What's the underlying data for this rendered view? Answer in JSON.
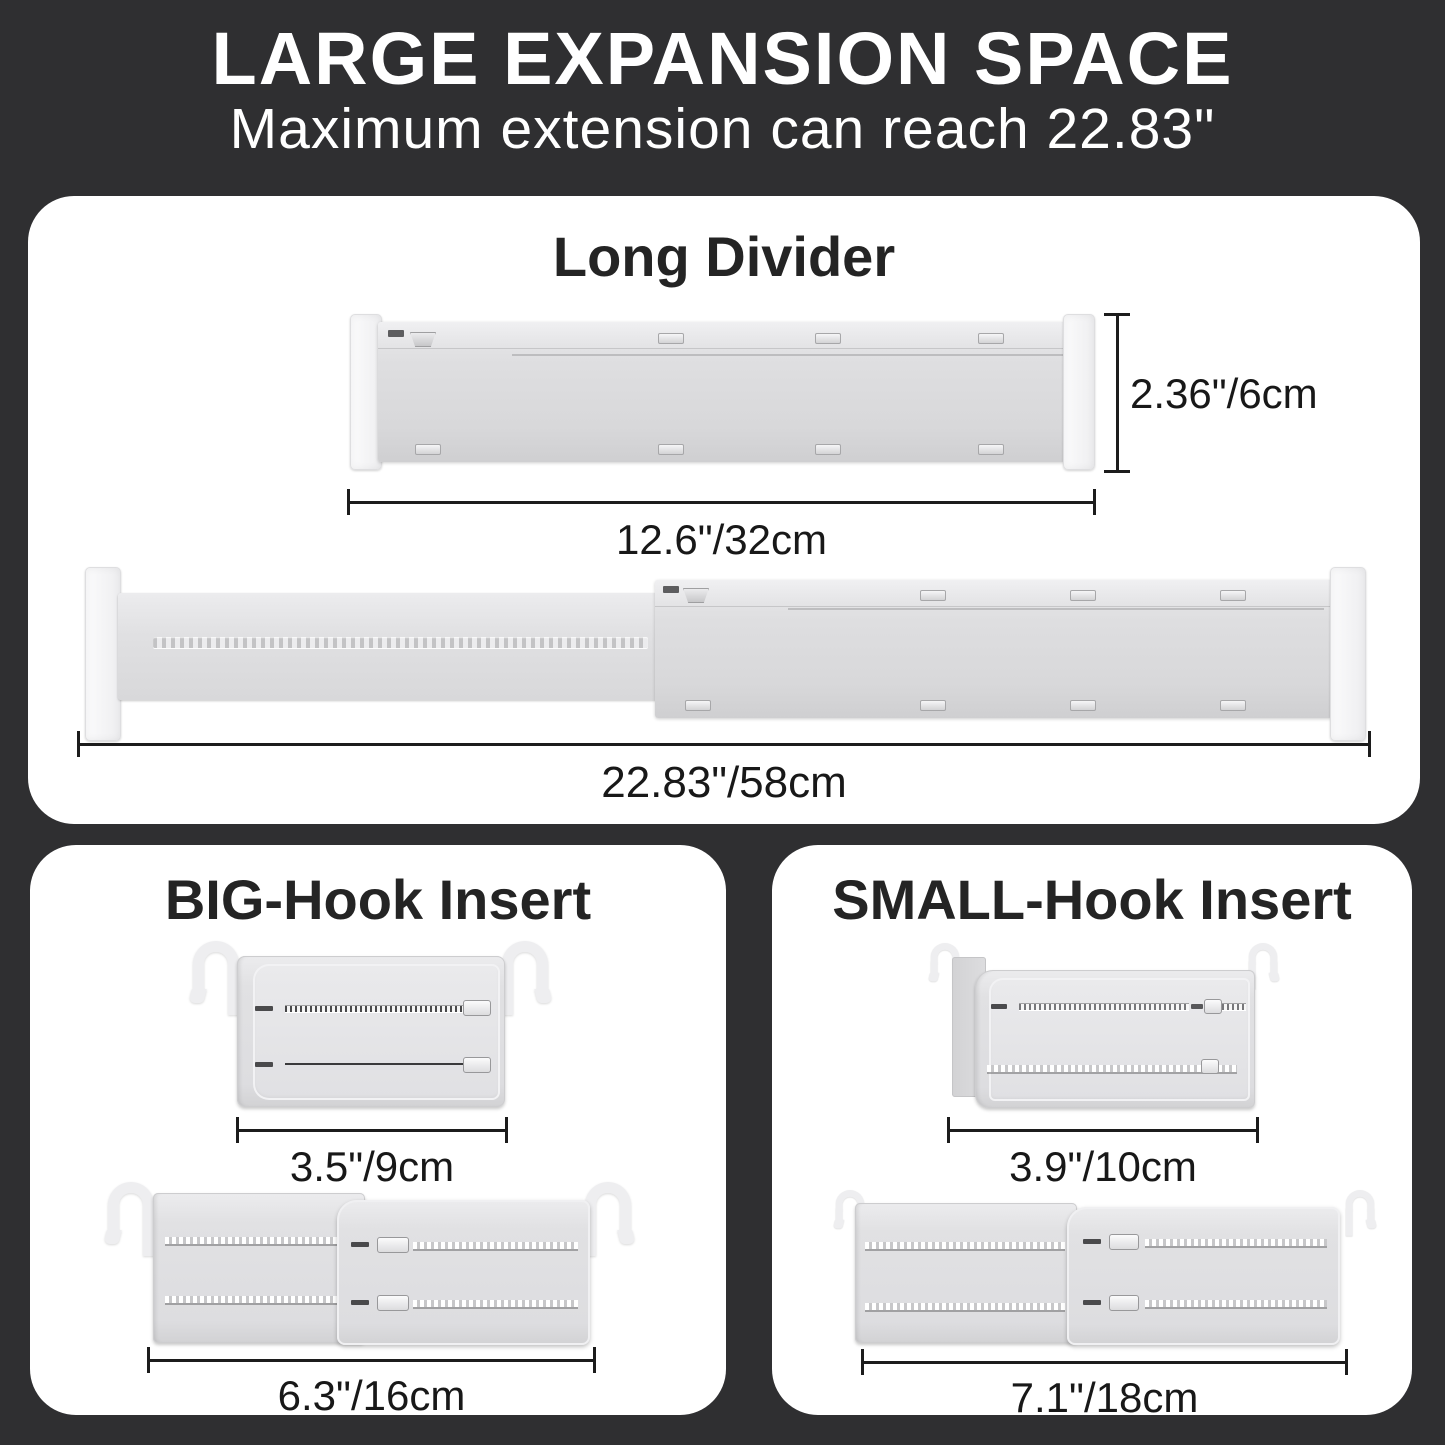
{
  "header": {
    "title": "LARGE EXPANSION SPACE",
    "subtitle": "Maximum extension can reach 22.83\""
  },
  "long_divider": {
    "title": "Long Divider",
    "height_label": "2.36\"/6cm",
    "collapsed_length_label": "12.6\"/32cm",
    "extended_length_label": "22.83\"/58cm"
  },
  "big_hook_insert": {
    "title": "BIG-Hook Insert",
    "collapsed_width_label": "3.5\"/9cm",
    "extended_width_label": "6.3\"/16cm"
  },
  "small_hook_insert": {
    "title": "SMALL-Hook Insert",
    "collapsed_width_label": "3.9\"/10cm",
    "extended_width_label": "7.1\"/18cm"
  },
  "colors": {
    "background": "#2f2f31",
    "panel": "#ffffff",
    "heading_text": "#ffffff",
    "panel_title_text": "#242424",
    "dimension_line": "#1c1c1c",
    "divider_body": "#dcdcde",
    "divider_cap": "#f6f6f7",
    "insert_body": "#e3e3e5"
  }
}
